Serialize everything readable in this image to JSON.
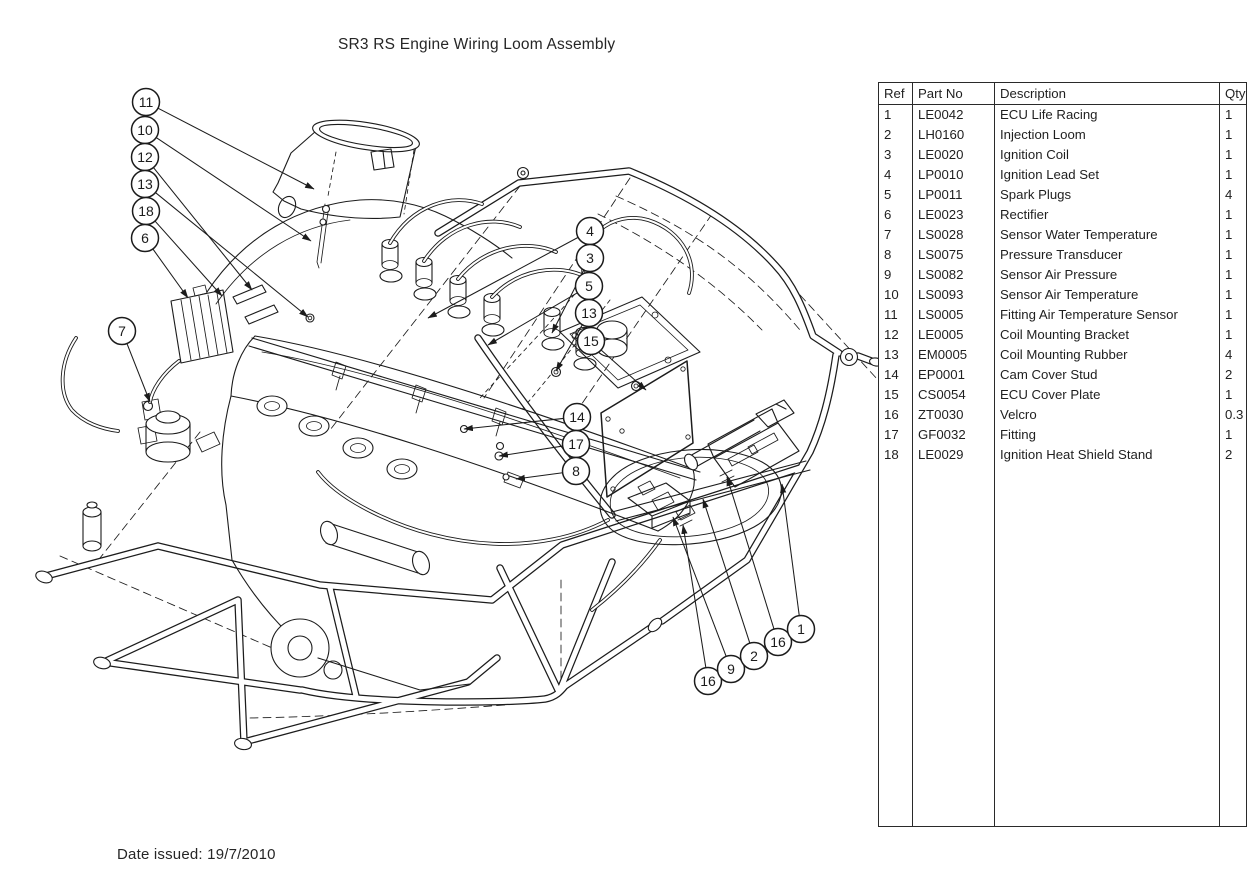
{
  "title": "SR3 RS Engine Wiring Loom Assembly",
  "date_issued": "Date issued: 19/7/2010",
  "colors": {
    "line": "#1c1c1c",
    "background": "#ffffff"
  },
  "parts_table": {
    "headers": [
      "Ref",
      "Part No",
      "Description",
      "Qty"
    ],
    "rows": [
      [
        "1",
        "LE0042",
        "ECU Life Racing",
        "1"
      ],
      [
        "2",
        "LH0160",
        "Injection Loom",
        "1"
      ],
      [
        "3",
        "LE0020",
        "Ignition Coil",
        "1"
      ],
      [
        "4",
        "LP0010",
        "Ignition Lead Set",
        "1"
      ],
      [
        "5",
        "LP0011",
        "Spark Plugs",
        "4"
      ],
      [
        "6",
        "LE0023",
        "Rectifier",
        "1"
      ],
      [
        "7",
        "LS0028",
        "Sensor Water Temperature",
        "1"
      ],
      [
        "8",
        "LS0075",
        "Pressure Transducer",
        "1"
      ],
      [
        "9",
        "LS0082",
        "Sensor Air Pressure",
        "1"
      ],
      [
        "10",
        "LS0093",
        "Sensor Air Temperature",
        "1"
      ],
      [
        "11",
        "LS0005",
        "Fitting Air Temperature Sensor",
        "1"
      ],
      [
        "12",
        "LE0005",
        "Coil Mounting Bracket",
        "1"
      ],
      [
        "13",
        "EM0005",
        "Coil Mounting Rubber",
        "4"
      ],
      [
        "14",
        "EP0001",
        "Cam Cover Stud",
        "2"
      ],
      [
        "15",
        "CS0054",
        "ECU Cover Plate",
        "1"
      ],
      [
        "16",
        "ZT0030",
        "Velcro",
        "0.3"
      ],
      [
        "17",
        "GF0032",
        "Fitting",
        "1"
      ],
      [
        "18",
        "LE0029",
        "Ignition Heat Shield Stand",
        "2"
      ]
    ]
  },
  "diagram": {
    "description": "Isometric engineering line drawing of the SR3 RS engine wiring loom installed in the tubular chassis, with numbered callout balloons",
    "balloons": [
      {
        "ref": "11",
        "cx": 146,
        "cy": 102,
        "tx": 314,
        "ty": 189
      },
      {
        "ref": "10",
        "cx": 145,
        "cy": 130,
        "tx": 311,
        "ty": 241
      },
      {
        "ref": "12",
        "cx": 145,
        "cy": 157,
        "tx": 252,
        "ty": 290
      },
      {
        "ref": "13",
        "cx": 145,
        "cy": 184,
        "tx": 308,
        "ty": 317
      },
      {
        "ref": "18",
        "cx": 146,
        "cy": 211,
        "tx": 222,
        "ty": 296
      },
      {
        "ref": "6",
        "cx": 145,
        "cy": 238,
        "tx": 188,
        "ty": 298
      },
      {
        "ref": "7",
        "cx": 122,
        "cy": 331,
        "tx": 150,
        "ty": 402
      },
      {
        "ref": "4",
        "cx": 590,
        "cy": 231,
        "tx": 428,
        "ty": 318
      },
      {
        "ref": "3",
        "cx": 590,
        "cy": 258,
        "tx": 552,
        "ty": 333
      },
      {
        "ref": "5",
        "cx": 589,
        "cy": 286,
        "tx": 488,
        "ty": 345
      },
      {
        "ref": "13",
        "cx": 589,
        "cy": 313,
        "tx": 556,
        "ty": 371
      },
      {
        "ref": "15",
        "cx": 591,
        "cy": 341,
        "tx": 646,
        "ty": 390
      },
      {
        "ref": "14",
        "cx": 577,
        "cy": 417,
        "tx": 464,
        "ty": 429
      },
      {
        "ref": "17",
        "cx": 576,
        "cy": 444,
        "tx": 499,
        "ty": 456
      },
      {
        "ref": "8",
        "cx": 576,
        "cy": 471,
        "tx": 516,
        "ty": 479
      },
      {
        "ref": "16",
        "cx": 708,
        "cy": 681,
        "tx": 683,
        "ty": 525
      },
      {
        "ref": "9",
        "cx": 731,
        "cy": 669,
        "tx": 673,
        "ty": 517
      },
      {
        "ref": "2",
        "cx": 754,
        "cy": 656,
        "tx": 703,
        "ty": 499
      },
      {
        "ref": "16",
        "cx": 778,
        "cy": 642,
        "tx": 727,
        "ty": 477
      },
      {
        "ref": "1",
        "cx": 801,
        "cy": 629,
        "tx": 782,
        "ty": 484
      }
    ]
  }
}
